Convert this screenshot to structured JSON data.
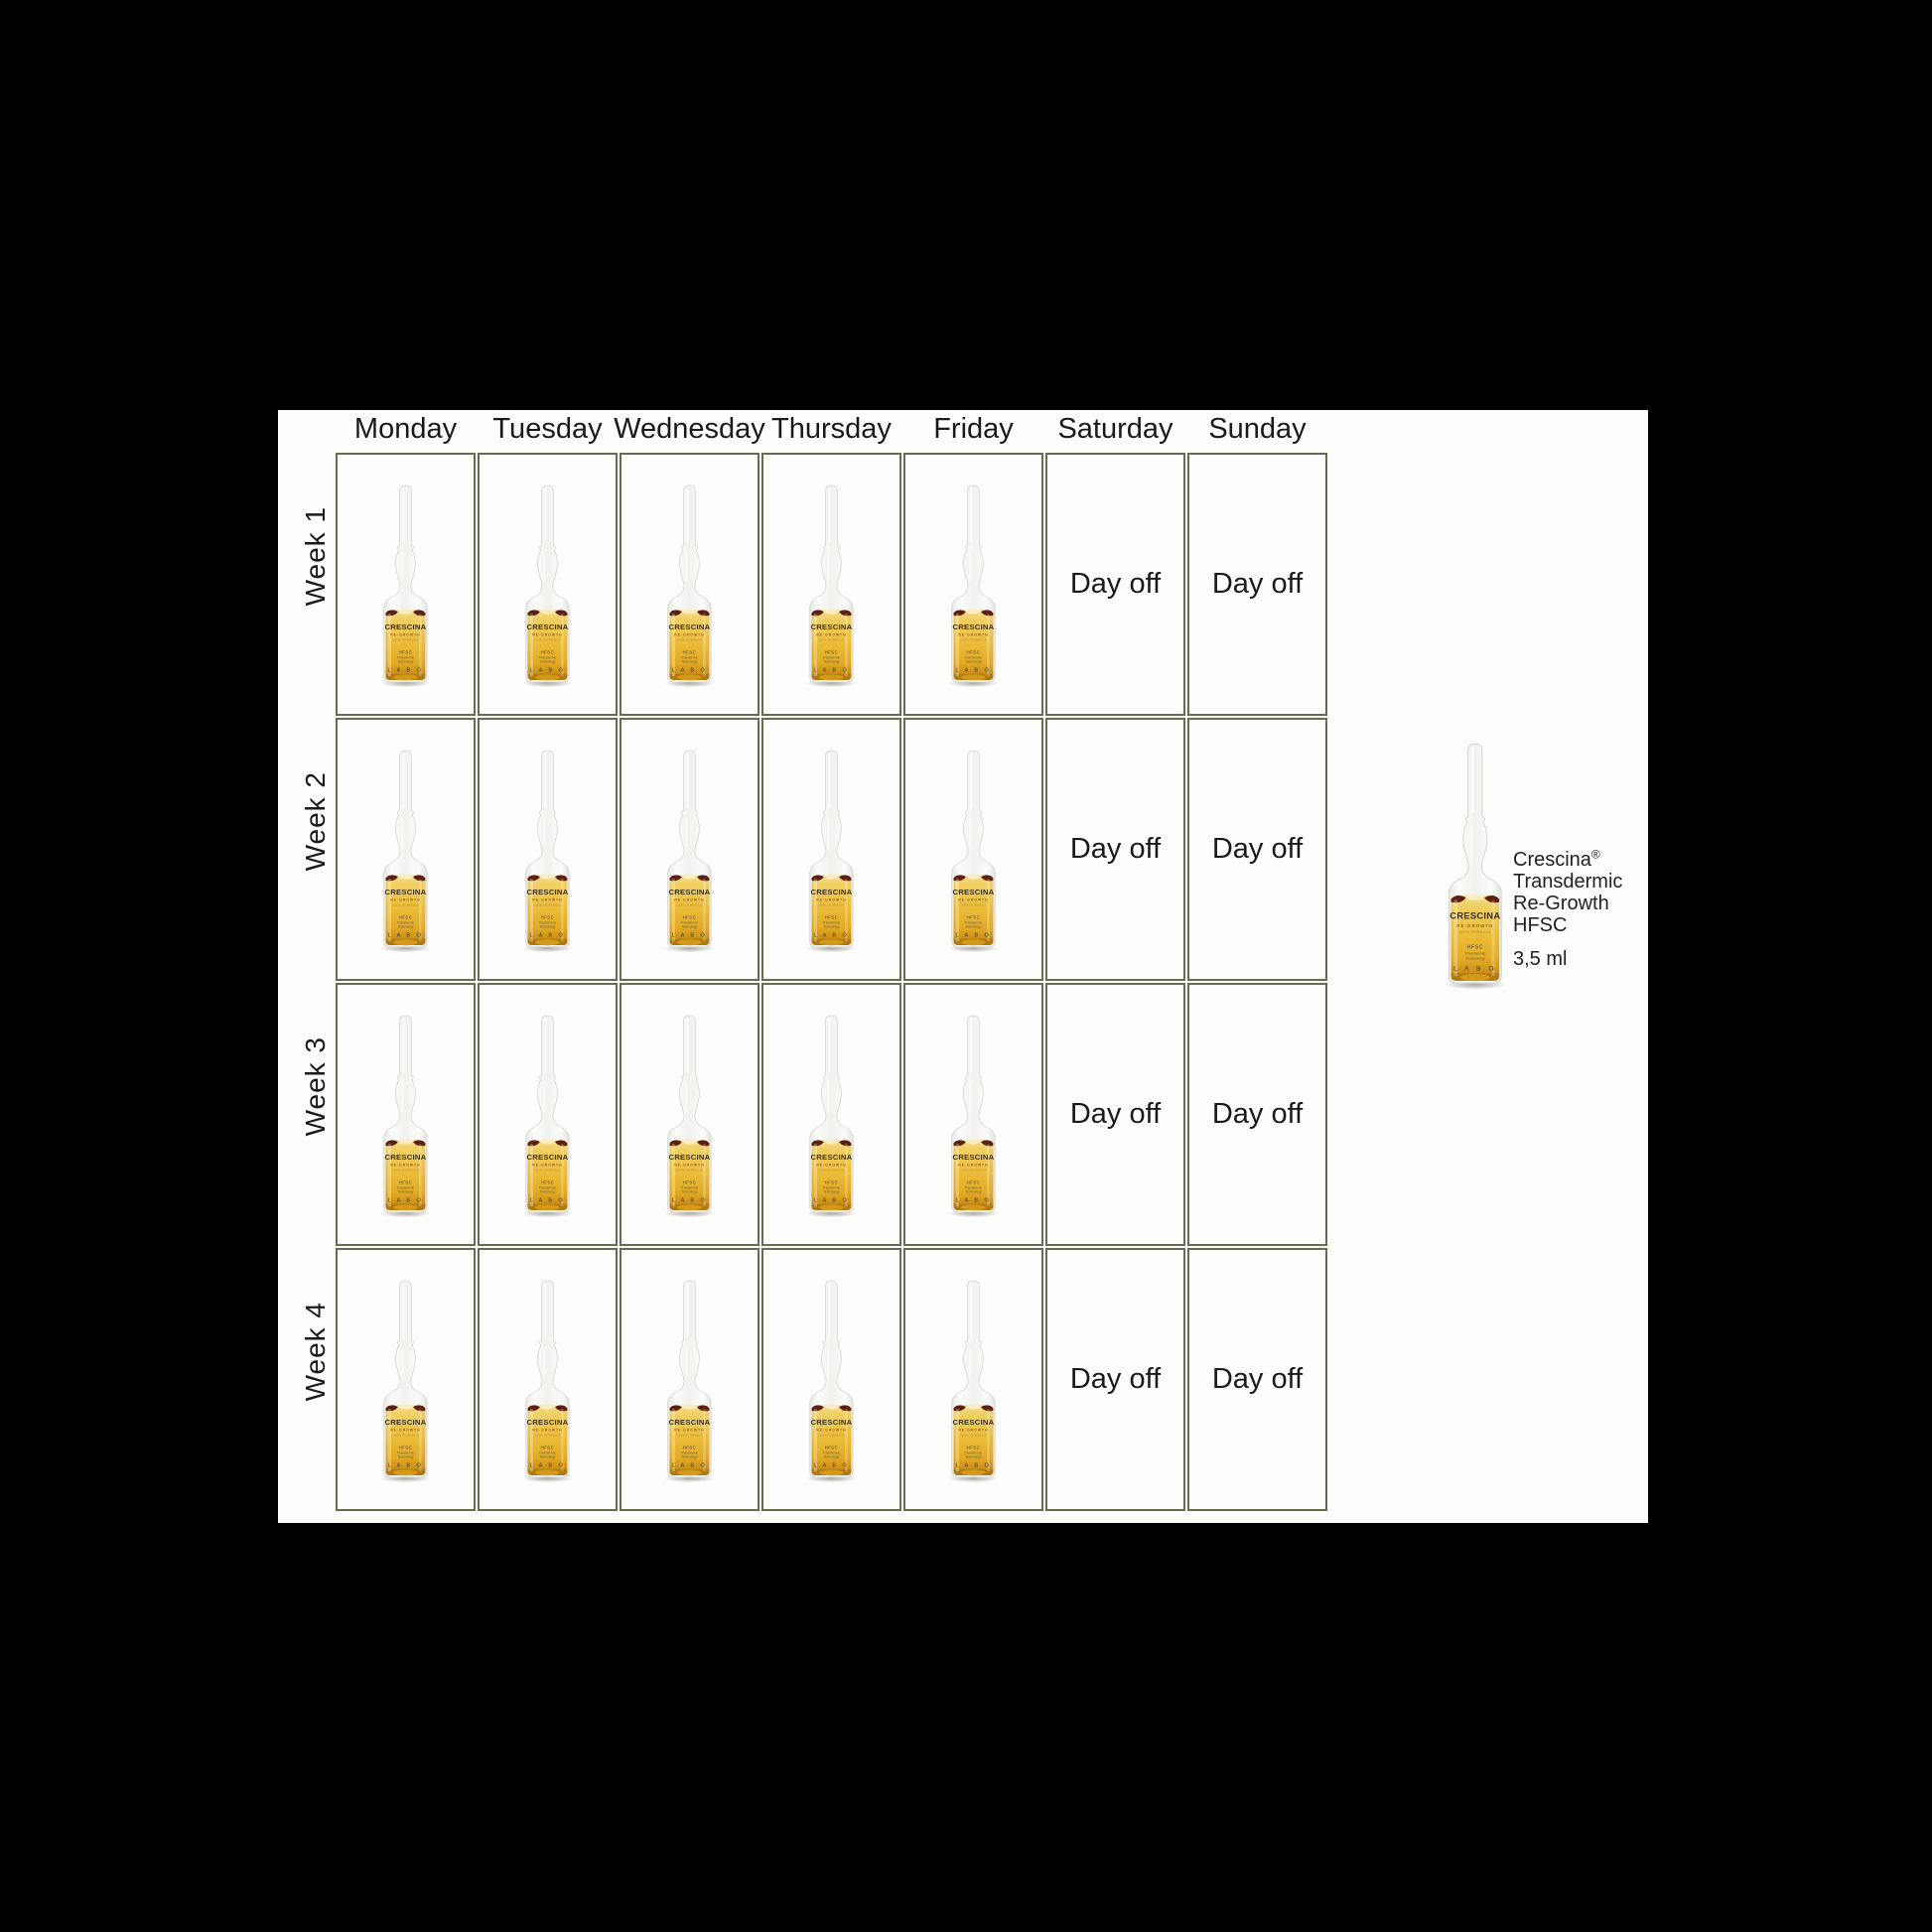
{
  "colors": {
    "background": "#000000",
    "panel_background": "#fdfdfc",
    "grid_border": "#6b6a52",
    "text": "#1a1a1a",
    "liquid_amber": "#ecbe3c",
    "wing_maroon": "#5c1f10"
  },
  "schedule": {
    "day_headers": [
      "Monday",
      "Tuesday",
      "Wednesday",
      "Thursday",
      "Friday",
      "Saturday",
      "Sunday"
    ],
    "day_off_label": "Day off",
    "ampoule_icon": "ampoule-vial",
    "weeks": [
      {
        "label": "Week 1",
        "days": [
          "ampoule",
          "ampoule",
          "ampoule",
          "ampoule",
          "ampoule",
          "day_off",
          "day_off"
        ]
      },
      {
        "label": "Week 2",
        "days": [
          "ampoule",
          "ampoule",
          "ampoule",
          "ampoule",
          "ampoule",
          "day_off",
          "day_off"
        ]
      },
      {
        "label": "Week 3",
        "days": [
          "ampoule",
          "ampoule",
          "ampoule",
          "ampoule",
          "ampoule",
          "day_off",
          "day_off"
        ]
      },
      {
        "label": "Week 4",
        "days": [
          "ampoule",
          "ampoule",
          "ampoule",
          "ampoule",
          "ampoule",
          "day_off",
          "day_off"
        ]
      }
    ]
  },
  "product": {
    "brand": "Crescina",
    "registered_mark": "®",
    "name_lines": [
      "Transdermic",
      "Re-Growth",
      "HFSC"
    ],
    "volume": "3,5 ml",
    "ampoule_label": {
      "brand": "CRESCINA",
      "range": "RE-GROWTH",
      "formula": "100% FORMULA",
      "tech1": "HFSC",
      "tech2": "Transdermic",
      "tech3": "Technology",
      "maker": "L A B O"
    }
  }
}
